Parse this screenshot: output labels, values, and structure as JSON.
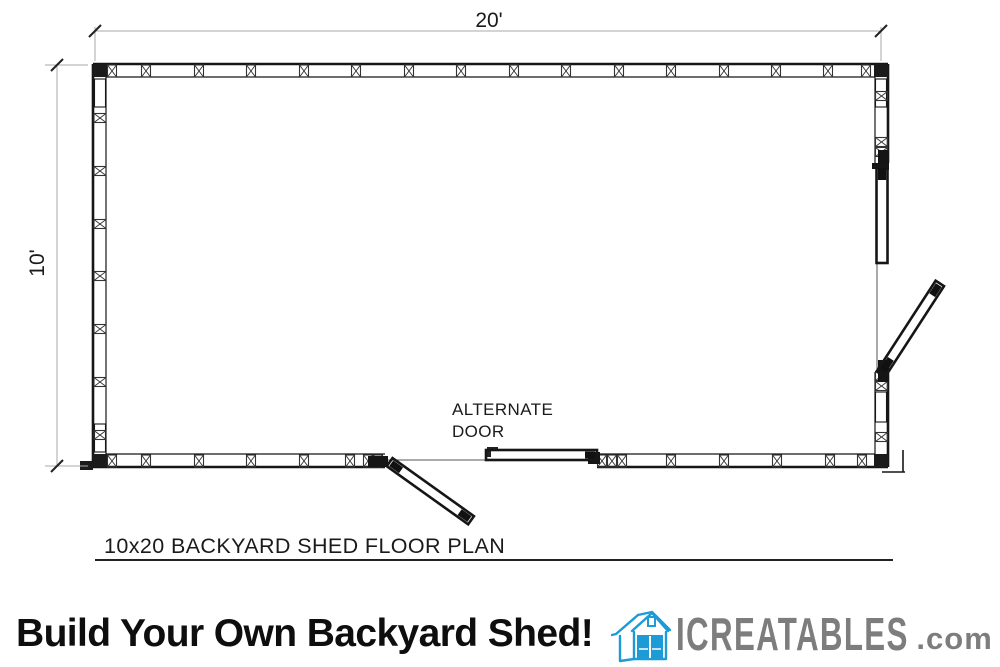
{
  "plan": {
    "width_dimension": "20'",
    "height_dimension": "10'",
    "alternate_door_line1": "ALTERNATE",
    "alternate_door_line2": "DOOR",
    "title": "10x20 BACKYARD SHED FLOOR PLAN"
  },
  "banner": {
    "headline": "Build Your Own Backyard Shed!",
    "brand_name": "ICREATABLES",
    "brand_suffix": ".com",
    "icon": "shed-icon",
    "colors": {
      "icon_blue": "#1d9bd7",
      "brand_gray": "#7d7d7d",
      "headline_black": "#0e0e0e",
      "wall_black": "#161616",
      "dim_gray": "#a8a8a8"
    }
  }
}
